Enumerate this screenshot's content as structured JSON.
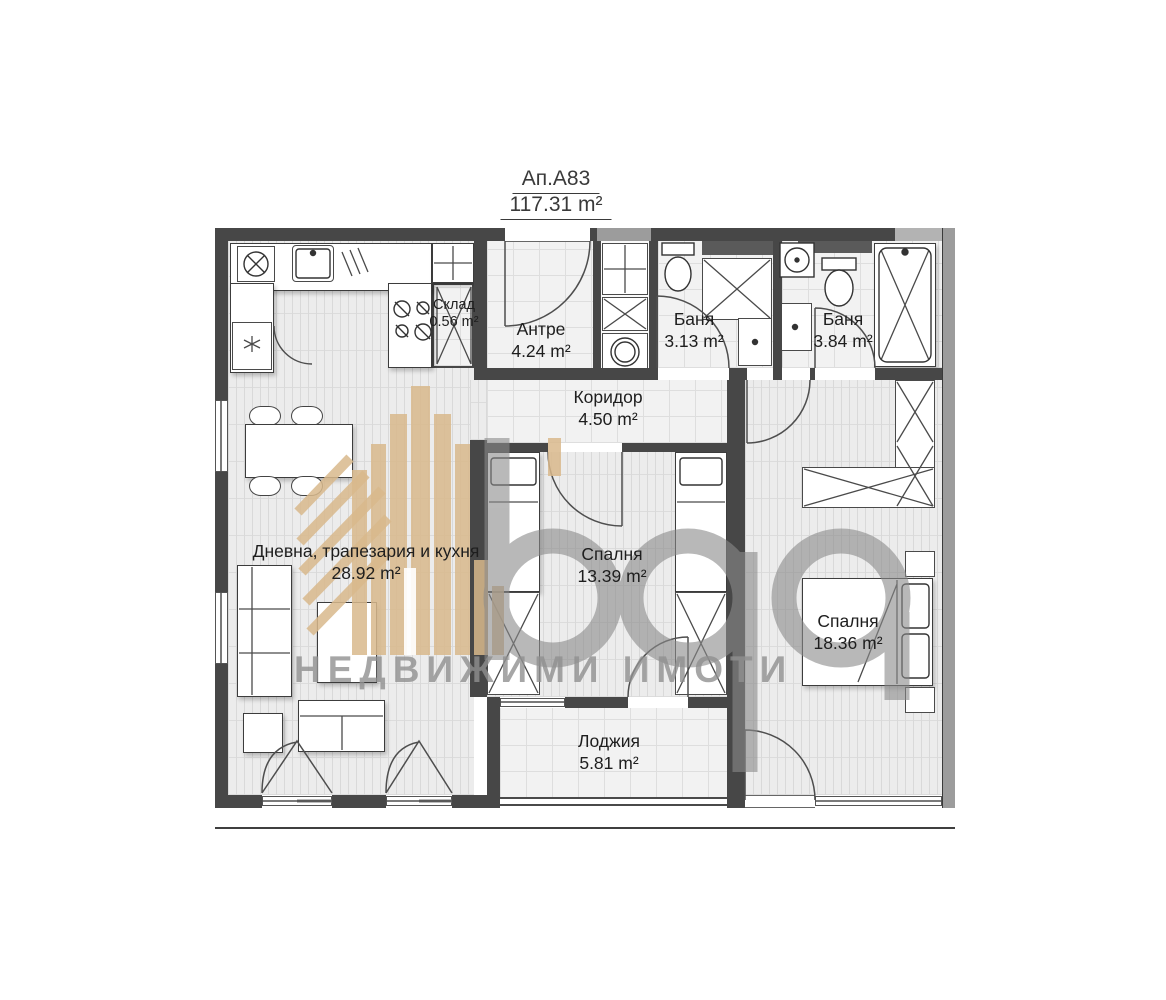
{
  "title": {
    "apartment": "Ап.А83",
    "total_area": "117.31 m²"
  },
  "rooms": [
    {
      "name": "Склад",
      "area": "0.56 m²"
    },
    {
      "name": "Антре",
      "area": "4.24 m²"
    },
    {
      "name": "Баня",
      "area": "3.13 m²"
    },
    {
      "name": "Баня",
      "area": "3.84 m²"
    },
    {
      "name": "Коридор",
      "area": "4.50 m²"
    },
    {
      "name": "Дневна, трапезария и кухня",
      "area": "28.92 m²"
    },
    {
      "name": "Спалня",
      "area": "13.39 m²"
    },
    {
      "name": "Спалня",
      "area": "18.36 m²"
    },
    {
      "name": "Лоджия",
      "area": "5.81 m²"
    }
  ],
  "watermark": {
    "agency_text": "НЕДВИЖИМИ ИМОТИ"
  },
  "colors": {
    "wall_dark": "#474747",
    "wall_medium": "#9c9c9c",
    "watermark_tan": "#d9b98c",
    "watermark_gray": "#8a8a8a",
    "label_text": "#1e1e1e"
  }
}
